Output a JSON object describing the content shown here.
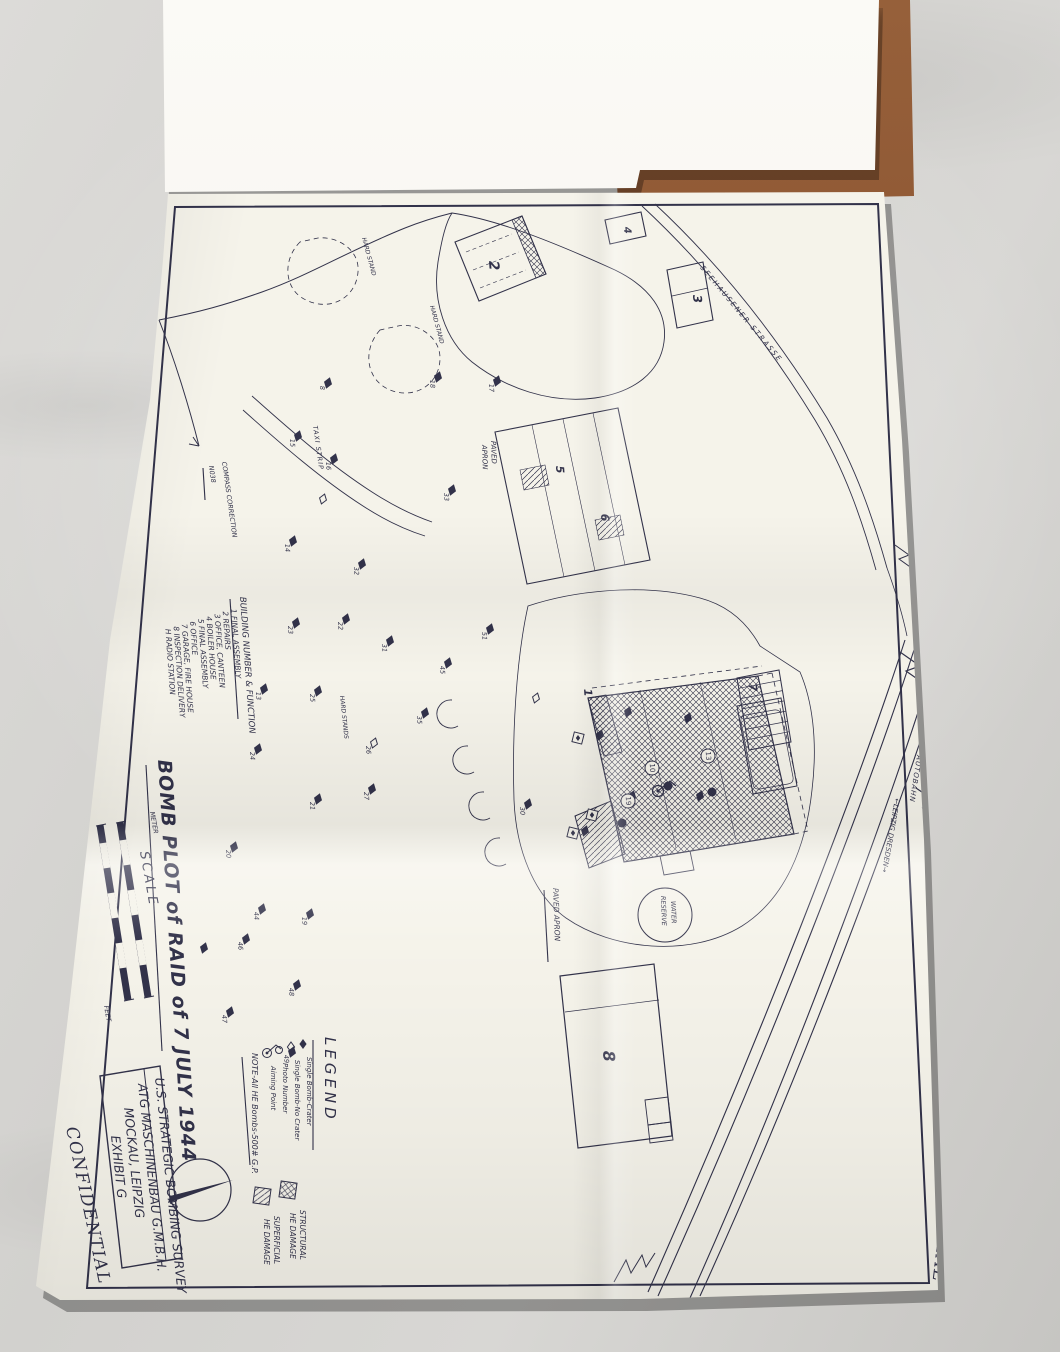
{
  "colors": {
    "ink": "#32324a",
    "paper": "#f5f3ea",
    "cover": "#8a5230",
    "fabric": "#d5d4d1"
  },
  "stamps": {
    "left": "CONFIDENTIAL",
    "right": "CONFIDENTIAL"
  },
  "title_block": {
    "line1": "U.S. STRATEGIC BOMBING SURVEY",
    "line2": "ATG MASCHINENBAU G.M.B.H.",
    "line3": "MOCKAU, LEIPZIG",
    "line4": "EXHIBIT G"
  },
  "map": {
    "title": "BOMB PLOT of RAID of 7 JULY 1944",
    "building_list": {
      "heading": "BUILDING NUMBER & FUNCTION",
      "items": [
        "1 FINAL ASSEMBLY",
        "2 REPAIRS",
        "3 OFFICE, CANTEEN",
        "4 BOILER HOUSE",
        "5 FINAL ASSEMBLY",
        "6 OFFICE",
        "7 GARAGE, FIRE HOUSE",
        "8 INSPECTION DELIVERY",
        "H RADIO STATION"
      ]
    },
    "legend": {
      "title": "LEGEND",
      "items": [
        {
          "symbol": "filled-diamond",
          "label": "Single Bomb-Crater"
        },
        {
          "symbol": "open-diamond",
          "label": "Single Bomb-No Crater"
        },
        {
          "symbol": "circle",
          "label": "Photo Number"
        },
        {
          "symbol": "aiming-point",
          "label": "Aiming Point"
        }
      ],
      "note": "NOTE-All HE Bombs-500# G.P.",
      "damage": [
        {
          "pattern": "crosshatch",
          "label1": "STRUCTURAL",
          "label2": "HE DAMAGE"
        },
        {
          "pattern": "diagonal",
          "label1": "SUPERFICIAL",
          "label2": "HE DAMAGE"
        }
      ]
    },
    "scale": {
      "label": "SCALE",
      "meter": "METER",
      "feet": "FEET"
    },
    "compass": {
      "label": "COMPASS CORRECTION",
      "value": "N038"
    },
    "labels": {
      "paved_apron_1a": "PAVED",
      "paved_apron_1b": "APRON",
      "paved_apron_2": "PAVED APRON",
      "taxi_strip": "TAXI STRIP",
      "hard_stand_1": "HARD STAND",
      "hard_stand_2": "HARD STAND",
      "hard_stand_3": "HARD STANDS",
      "water_reserve_1": "WATER",
      "water_reserve_2": "RESERVE",
      "autobahn": "AUTOBAHN",
      "autobahn_dir": "←LEIPZIG   DRESDEN→",
      "strasse": "SEEHAUSENER  STRASSE"
    },
    "buildings": [
      {
        "n": "1",
        "x": 584,
        "y": 689,
        "s": 11
      },
      {
        "n": "2",
        "x": 489,
        "y": 261,
        "s": 14
      },
      {
        "n": "3",
        "x": 693,
        "y": 295,
        "s": 12
      },
      {
        "n": "4",
        "x": 624,
        "y": 227,
        "s": 10
      },
      {
        "n": "5",
        "x": 556,
        "y": 466,
        "s": 11
      },
      {
        "n": "6",
        "x": 601,
        "y": 514,
        "s": 11
      },
      {
        "n": "7",
        "x": 749,
        "y": 684,
        "s": 11
      },
      {
        "n": "8",
        "x": 603,
        "y": 1051,
        "s": 16
      }
    ],
    "photo_circles": [
      {
        "x": 652,
        "y": 768,
        "n": "10"
      },
      {
        "x": 708,
        "y": 756,
        "n": "13"
      },
      {
        "x": 628,
        "y": 801,
        "n": "19"
      }
    ],
    "craters": [
      {
        "x": 328,
        "y": 383,
        "n": "8"
      },
      {
        "x": 438,
        "y": 377,
        "n": "18"
      },
      {
        "x": 497,
        "y": 381,
        "n": "17"
      },
      {
        "x": 298,
        "y": 436,
        "n": "15"
      },
      {
        "x": 334,
        "y": 459,
        "n": "16"
      },
      {
        "x": 452,
        "y": 490,
        "n": "33"
      },
      {
        "x": 323,
        "y": 499,
        "t": "o"
      },
      {
        "x": 293,
        "y": 541,
        "n": "14"
      },
      {
        "x": 362,
        "y": 564,
        "n": "32"
      },
      {
        "x": 296,
        "y": 623,
        "n": "23"
      },
      {
        "x": 346,
        "y": 619,
        "n": "22"
      },
      {
        "x": 390,
        "y": 641,
        "n": "31"
      },
      {
        "x": 490,
        "y": 629,
        "n": "51"
      },
      {
        "x": 448,
        "y": 663,
        "n": "45"
      },
      {
        "x": 264,
        "y": 689,
        "n": "13"
      },
      {
        "x": 318,
        "y": 691,
        "n": "25"
      },
      {
        "x": 425,
        "y": 713,
        "n": "35"
      },
      {
        "x": 374,
        "y": 743,
        "t": "o",
        "n": "26"
      },
      {
        "x": 258,
        "y": 749,
        "n": "24"
      },
      {
        "x": 318,
        "y": 799,
        "n": "21"
      },
      {
        "x": 372,
        "y": 789,
        "n": "27"
      },
      {
        "x": 528,
        "y": 804,
        "n": "30"
      },
      {
        "x": 234,
        "y": 847,
        "n": "20"
      },
      {
        "x": 262,
        "y": 909,
        "n": "44"
      },
      {
        "x": 310,
        "y": 914,
        "n": "19"
      },
      {
        "x": 246,
        "y": 939,
        "n": "46"
      },
      {
        "x": 204,
        "y": 948
      },
      {
        "x": 297,
        "y": 985,
        "n": "48"
      },
      {
        "x": 230,
        "y": 1012,
        "n": "47"
      },
      {
        "x": 292,
        "y": 1052,
        "n": "49"
      },
      {
        "x": 600,
        "y": 735
      },
      {
        "x": 628,
        "y": 712
      },
      {
        "x": 688,
        "y": 718
      },
      {
        "x": 632,
        "y": 796
      },
      {
        "x": 700,
        "y": 796
      },
      {
        "x": 585,
        "y": 831
      },
      {
        "x": 536,
        "y": 698,
        "t": "o"
      }
    ],
    "impact_dots": [
      {
        "x": 622,
        "y": 823
      },
      {
        "x": 668,
        "y": 786
      },
      {
        "x": 712,
        "y": 792
      }
    ],
    "flag_squares": [
      {
        "x": 578,
        "y": 738
      },
      {
        "x": 592,
        "y": 815
      },
      {
        "x": 573,
        "y": 833
      }
    ]
  }
}
